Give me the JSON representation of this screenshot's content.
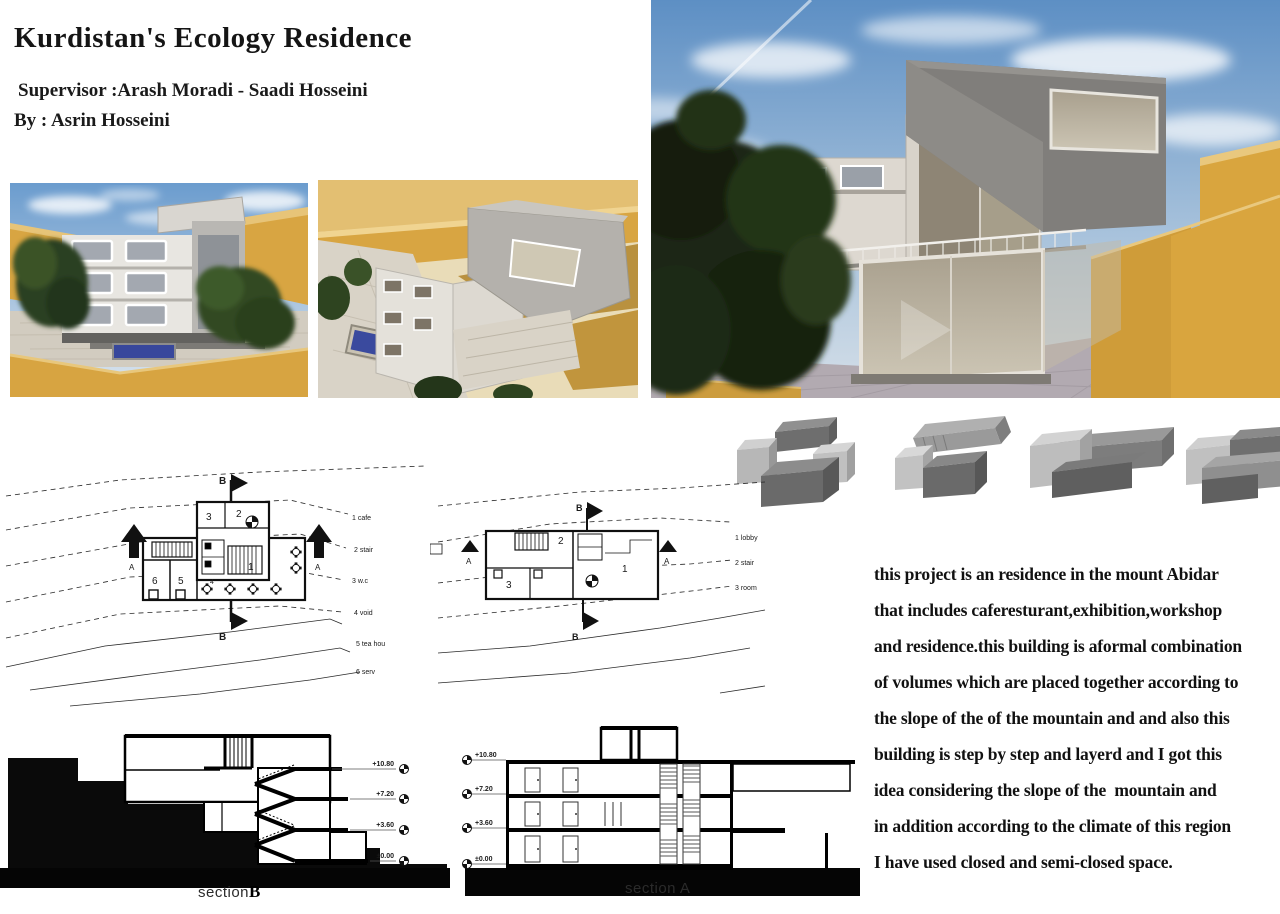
{
  "header": {
    "title": "Kurdistan's Ecology Residence",
    "supervisor": "Supervisor :Arash Moradi - Saadi Hosseini",
    "author": "By : Asrin Hosseini"
  },
  "description": {
    "lines": [
      "this project is an residence in the mount Abidar",
      "that includes caferesturant,exhibition,workshop",
      "and residence.this building is aformal combination",
      "of volumes which are placed together according to",
      "the slope of the of the mountain and and also this",
      "building is step by step and layerd and I got this",
      "idea considering the slope of the  mountain and",
      "in addition according to the climate of this region",
      "I have used closed and semi-closed space."
    ]
  },
  "plan_b": {
    "markers": {
      "top": "B",
      "bottom": "B",
      "left": "A",
      "right": "A"
    },
    "rooms": [
      "1",
      "2",
      "3",
      "4",
      "5",
      "6"
    ],
    "legend": [
      "1 cafe",
      "2 stair",
      "3 w.c",
      "4 void",
      "5 tea hou",
      "6 serv"
    ]
  },
  "plan_a": {
    "markers": {
      "top": "B",
      "bottom": "B",
      "left": "A",
      "right": "A"
    },
    "rooms": [
      "1",
      "2",
      "3"
    ],
    "legend": [
      "1 lobby",
      "2 stair",
      "3 room"
    ]
  },
  "section_b": {
    "label_prefix": "section",
    "label_letter": "B",
    "levels": [
      "+10.80",
      "+7.20",
      "+3.60",
      "±0.00"
    ]
  },
  "section_a": {
    "label": "section A",
    "levels": [
      "+10.80",
      "+7.20",
      "+3.60",
      "±0.00"
    ]
  },
  "colors": {
    "sky_top": "#6b9cce",
    "sky_bottom": "#d8e2ea",
    "terrace_yellow": "#d8a542",
    "building_white": "#dcd7cf",
    "concrete_dark": "#807e7b",
    "glass": "#a89f8d",
    "pool_blue": "#37479c",
    "stone_ground": "#b2aab1",
    "tree_green": "#1c2614",
    "drawing_ink": "#0f0f0f"
  }
}
